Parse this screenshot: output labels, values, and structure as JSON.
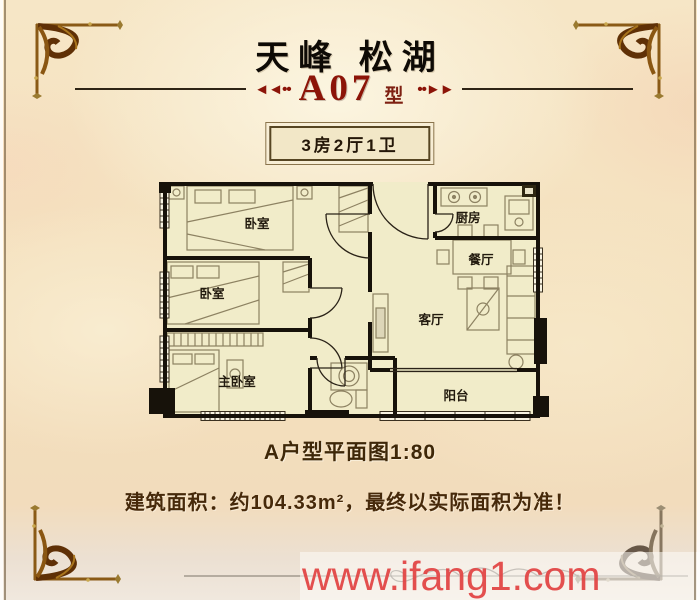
{
  "header": {
    "project_title": "天峰 松湖",
    "unit_code": "A07",
    "unit_type_suffix": "型",
    "arrows_left": "◄◄••",
    "arrows_right": "••►►",
    "badge": "3房2厅1卫"
  },
  "floorplan": {
    "rooms": [
      {
        "name": "bedroom-1",
        "label": "卧室"
      },
      {
        "name": "bedroom-2",
        "label": "卧室"
      },
      {
        "name": "master-bedroom",
        "label": "主卧室"
      },
      {
        "name": "kitchen",
        "label": "厨房"
      },
      {
        "name": "dining-room",
        "label": "餐厅"
      },
      {
        "name": "living-room",
        "label": "客厅"
      },
      {
        "name": "balcony",
        "label": "阳台"
      }
    ],
    "scale": "1:80",
    "building_area_m2": "104.33"
  },
  "footer": {
    "caption": "A户型平面图1:80",
    "area_note": "建筑面积：约104.33m²，最终以实际面积为准！",
    "watermark": "www.ifang1.com"
  },
  "colors": {
    "title_ink": "#0e0a05",
    "unit_red": "#8c1408",
    "wall_ink": "#17120a",
    "room_fill": "#f1ecc9",
    "gold_ornament": "#7d4a10",
    "note_brown": "#46290a",
    "watermark_red": "#e24646",
    "paper": "#f4e0bd"
  }
}
